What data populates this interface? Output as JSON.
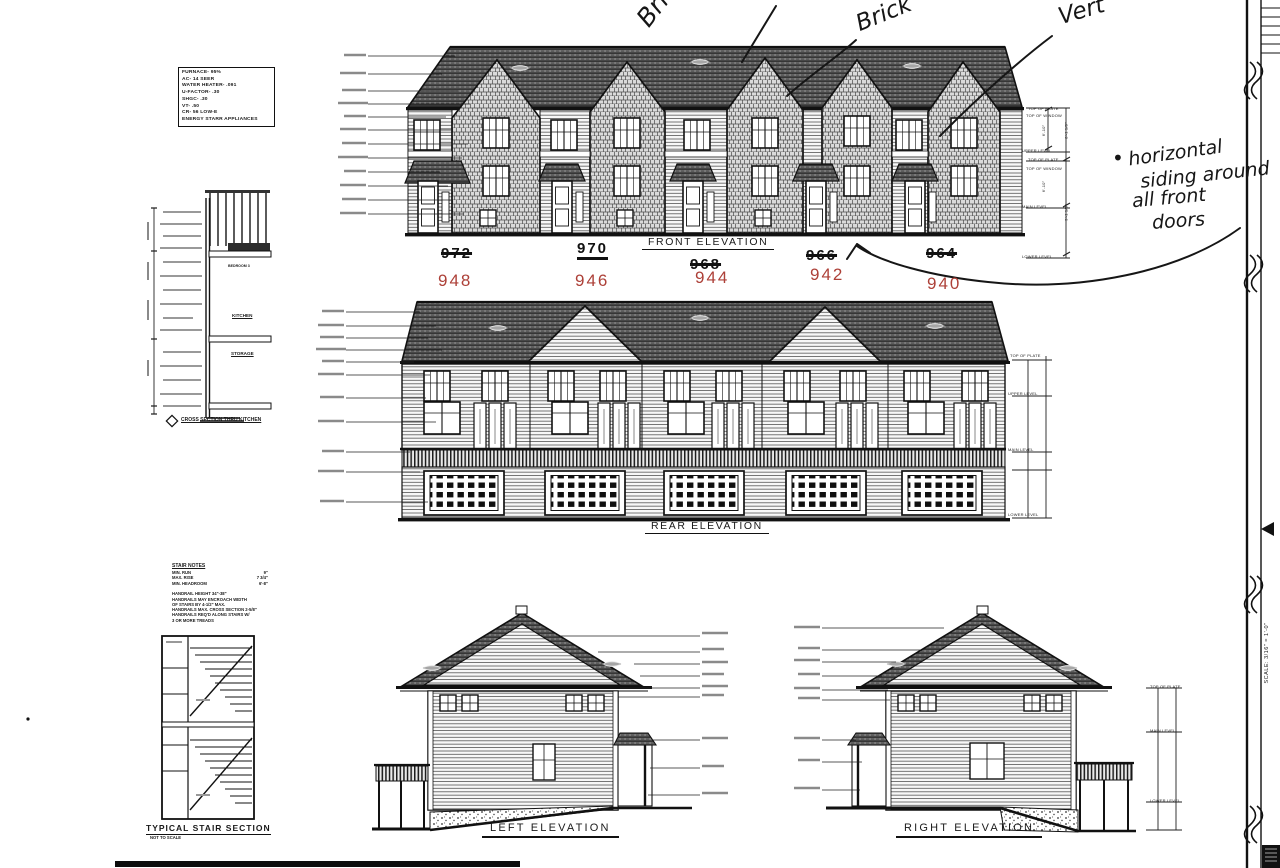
{
  "palette": {
    "ink": "#1a1a1a",
    "red": "#ad4038",
    "roof": "#2a2a2a",
    "paper": "#ffffff"
  },
  "spec_box": {
    "lines": [
      "FURNACE- 95%",
      "AC- 14 SEER",
      "WATER HEATER- .091",
      "U-FACTOR- .30",
      "SHGC- .30",
      "VT- .50",
      "CR- 56 LOW-E",
      "ENERGY STARR APPLIANCES"
    ]
  },
  "handwriting": {
    "top_labels": [
      "Brick",
      "Brick",
      "Vert"
    ],
    "note": {
      "bullet": "•",
      "lines": [
        "horizontal",
        "siding around",
        "all front",
        "doors"
      ]
    }
  },
  "front": {
    "title": "FRONT ELEVATION",
    "old_numbers": [
      "972",
      "970",
      "968",
      "966",
      "964"
    ],
    "new_numbers": [
      "948",
      "946",
      "944",
      "942",
      "940"
    ],
    "levels": [
      "TOP OF PLATE",
      "TOP OF WINDOW",
      "UPPER LEVEL",
      "TOP OF PLATE",
      "TOP OF WINDOW",
      "MAIN LEVEL",
      "LOWER LEVEL"
    ],
    "dims": [
      "6'-10\"",
      "8'-1 1/8\"",
      "6'-10\"",
      "9'-1 1/8\""
    ]
  },
  "rear": {
    "title": "REAR ELEVATION"
  },
  "left": {
    "title": "LEFT ELEVATION"
  },
  "right": {
    "title": "RIGHT ELEVATION"
  },
  "cross_section": {
    "title": "CROSS SECTION THRU KITCHEN",
    "rooms": [
      "BEDROOM 3",
      "KITCHEN",
      "STORAGE"
    ]
  },
  "stairs": {
    "notes_title": "STAIR NOTES",
    "rows": [
      [
        "MIN. RUN",
        "9\""
      ],
      [
        "MAX. RISE",
        "7 3/4\""
      ],
      [
        "MIN. HEADROOM",
        "6'-8\""
      ]
    ],
    "handrail_lines": [
      "HANDRAIL HEIGHT 34\"-38\"",
      "HANDRAILS MAY ENCROACH WIDTH",
      "OF STAIRS BY 4-1/2\" MAX.",
      "HANDRAILS MAX. CROSS SECTION 2-5/8\"",
      "HANDRAILS REQ'D ALONG STAIRS W/",
      "3 OR MORE TREADS"
    ],
    "title": "TYPICAL STAIR SECTION",
    "subtitle": "NOT TO SCALE"
  },
  "title_block": {
    "scale_text": "SCALE: 3/16\" = 1'-0\""
  }
}
